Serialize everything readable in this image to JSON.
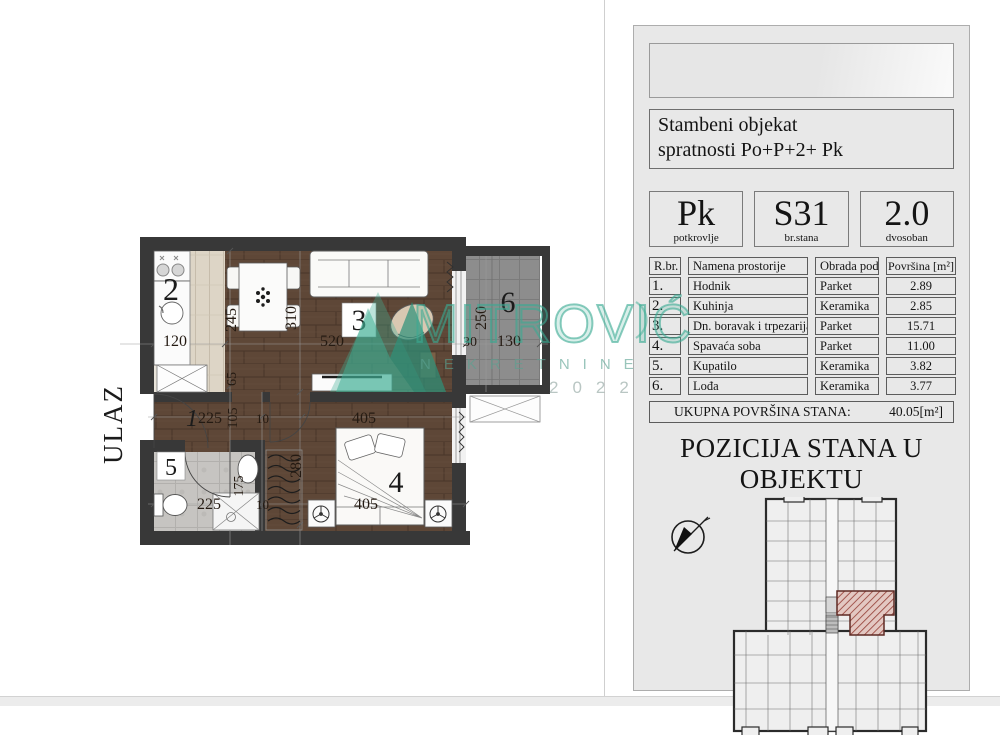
{
  "watermark": {
    "brand": "MITROVIĆ",
    "subtitle": "NEKRETNINE",
    "year": "2022"
  },
  "plan": {
    "entrance_label": "ULAZ",
    "rooms": {
      "r1": "1",
      "r2": "2",
      "r3": "3",
      "r4": "4",
      "r5": "5",
      "r6": "6"
    },
    "dims": {
      "kitchen_w": "120",
      "dining_w": "245",
      "living_d": "310",
      "living_w": "520",
      "hall_a": "65",
      "hall_b": "105",
      "hall_w": "225",
      "wall_a": "10",
      "bedroom_d": "280",
      "bath_d": "175",
      "bath_w": "225",
      "wall_b": "10",
      "bedroom_w": "405",
      "bed_w": "405",
      "loggia_d": "250",
      "loggia_w": "130",
      "loggia_a": "30"
    }
  },
  "panel": {
    "title_line1": "Stambeni objekat",
    "title_line2": "spratnosti Po+P+2+ Pk",
    "stats": [
      {
        "value": "Pk",
        "caption": "potkrovlje"
      },
      {
        "value": "S31",
        "caption": "br.stana"
      },
      {
        "value": "2.0",
        "caption": "dvosoban"
      }
    ],
    "table": {
      "headers": [
        "R.br.",
        "Namena prostorije",
        "Obrada poda",
        "Površina [m²]"
      ],
      "rows": [
        {
          "num": "1.",
          "name": "Hodnik",
          "floor": "Parket",
          "area": "2.89"
        },
        {
          "num": "2.",
          "name": "Kuhinja",
          "floor": "Keramika",
          "area": "2.85"
        },
        {
          "num": "3.",
          "name": "Dn. boravak i trpezarija",
          "floor": "Parket",
          "area": "15.71"
        },
        {
          "num": "4.",
          "name": "Spavaća soba",
          "floor": "Parket",
          "area": "11.00"
        },
        {
          "num": "5.",
          "name": "Kupatilo",
          "floor": "Keramika",
          "area": "3.82"
        },
        {
          "num": "6.",
          "name": "Lođa",
          "floor": "Keramika",
          "area": "3.77"
        }
      ]
    },
    "total": {
      "label": "UKUPNA POVRŠINA STANA:",
      "value": "40.05[m²]"
    },
    "position_title": "POZICIJA STANA U OBJEKTU"
  },
  "colors": {
    "watermark_green": "#3fae94",
    "hatch_red": "#9c4a42",
    "wall": "#383838",
    "wood": "#5e4737",
    "loggia": "#8d8d8d"
  }
}
